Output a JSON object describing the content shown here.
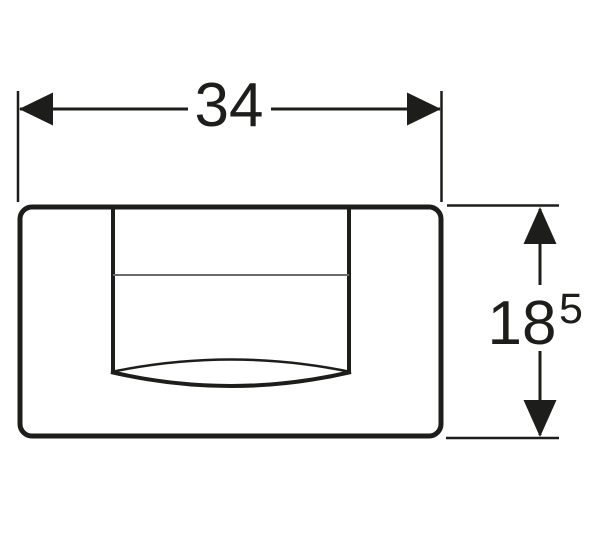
{
  "drawing": {
    "background_color": "#ffffff",
    "line_color": "#1d1d1b",
    "thin_line_color": "#6b6b6b",
    "dimensions": {
      "width": {
        "value": "34"
      },
      "height": {
        "main": "18",
        "sup": "5"
      }
    }
  }
}
